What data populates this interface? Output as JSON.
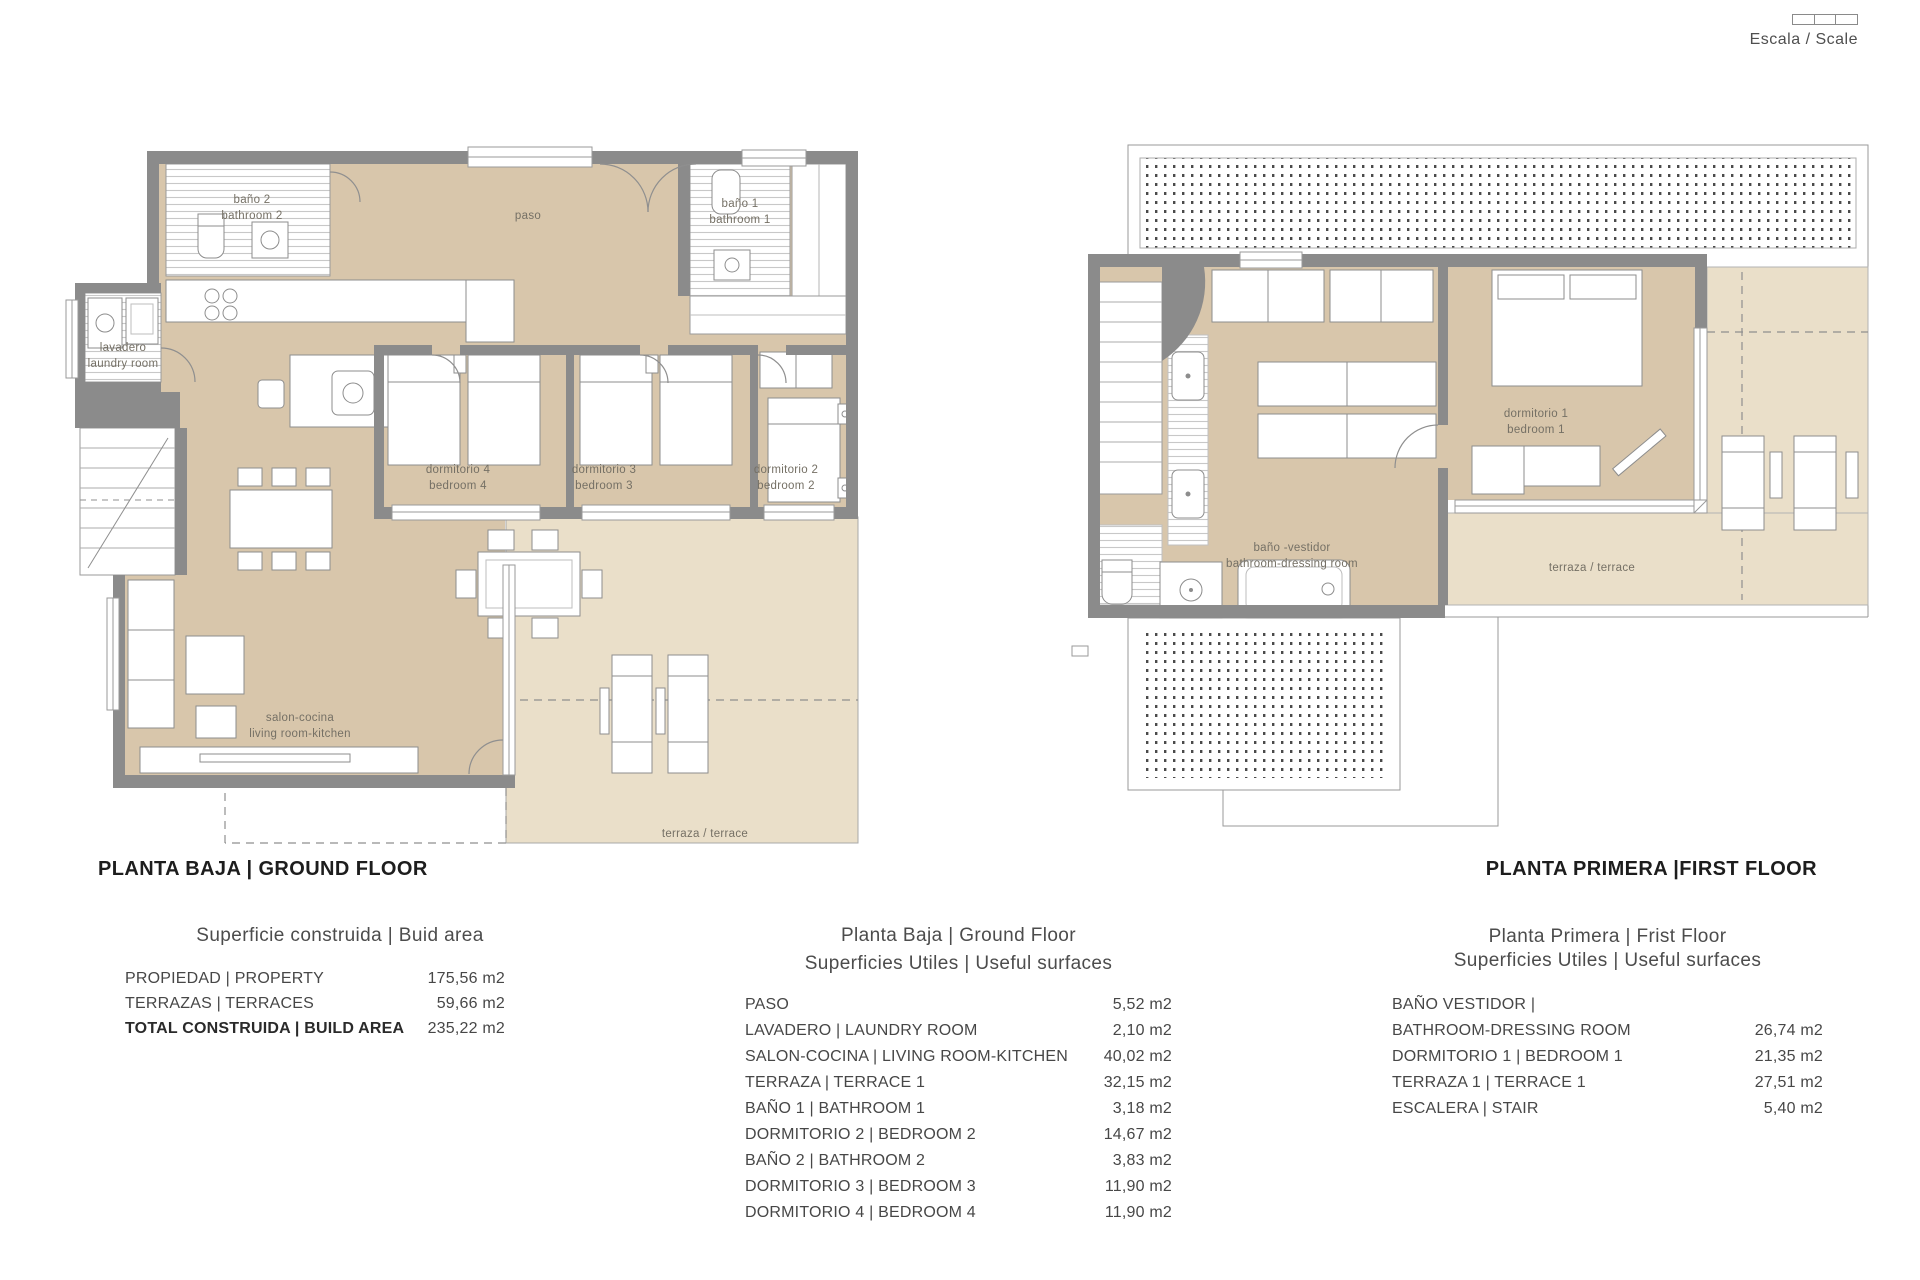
{
  "scale_widget": {
    "label": "Escala / Scale"
  },
  "ground_floor": {
    "title": "PLANTA BAJA | GROUND FLOOR",
    "rooms": {
      "bano2": {
        "l1": "baño 2",
        "l2": "bathroom 2"
      },
      "paso": {
        "l1": "paso"
      },
      "bano1": {
        "l1": "baño 1",
        "l2": "bathroom 1"
      },
      "lavadero": {
        "l1": "lavadero",
        "l2": "laundry room"
      },
      "dorm4": {
        "l1": "dormitorio 4",
        "l2": "bedroom 4"
      },
      "dorm3": {
        "l1": "dormitorio 3",
        "l2": "bedroom 3"
      },
      "dorm2": {
        "l1": "dormitorio 2",
        "l2": "bedroom 2"
      },
      "salon": {
        "l1": "salon-cocina",
        "l2": "living room-kitchen"
      },
      "terraza": {
        "l1": "terraza / terrace"
      }
    }
  },
  "first_floor": {
    "title": "PLANTA PRIMERA |FIRST FLOOR",
    "rooms": {
      "bano_vestidor": {
        "l1": "baño -vestidor",
        "l2": "bathroom-dressing room"
      },
      "dorm1": {
        "l1": "dormitorio 1",
        "l2": "bedroom 1"
      },
      "terraza": {
        "l1": "terraza / terrace"
      }
    }
  },
  "tables": {
    "build_area": {
      "header": "Superficie construida | Buid area",
      "rows": [
        {
          "label": "PROPIEDAD | PROPERTY",
          "value": "175,56 m2"
        },
        {
          "label": "TERRAZAS | TERRACES",
          "value": "59,66 m2"
        },
        {
          "label": "TOTAL CONSTRUIDA | BUILD AREA",
          "value": "235,22 m2"
        }
      ]
    },
    "ground_useful": {
      "header_l1": "Planta Baja | Ground Floor",
      "header_l2": "Superficies Utiles | Useful surfaces",
      "rows": [
        {
          "label": "PASO",
          "value": "5,52 m2"
        },
        {
          "label": "LAVADERO | LAUNDRY ROOM",
          "value": "2,10 m2"
        },
        {
          "label": "SALON-COCINA | LIVING ROOM-KITCHEN",
          "value": "40,02 m2"
        },
        {
          "label": "TERRAZA | TERRACE 1",
          "value": "32,15 m2"
        },
        {
          "label": "BAÑO 1 | BATHROOM 1",
          "value": "3,18 m2"
        },
        {
          "label": "DORMITORIO 2 | BEDROOM 2",
          "value": "14,67 m2"
        },
        {
          "label": "BAÑO 2 | BATHROOM 2",
          "value": "3,83 m2"
        },
        {
          "label": "DORMITORIO 3 | BEDROOM 3",
          "value": "11,90 m2"
        },
        {
          "label": "DORMITORIO 4 | BEDROOM 4",
          "value": "11,90 m2"
        }
      ]
    },
    "first_useful": {
      "header_l1": "Planta Primera | Frist Floor",
      "header_l2": "Superficies Utiles | Useful surfaces",
      "rows": [
        {
          "label": "BAÑO VESTIDOR |",
          "value": ""
        },
        {
          "label": "BATHROOM-DRESSING ROOM",
          "value": "26,74 m2"
        },
        {
          "label": "DORMITORIO 1 | BEDROOM 1",
          "value": "21,35 m2"
        },
        {
          "label": "TERRAZA 1 | TERRACE 1",
          "value": "27,51 m2"
        },
        {
          "label": "ESCALERA | STAIR",
          "value": "5,40 m2"
        }
      ]
    }
  },
  "colors": {
    "wall": "#8b8b8b",
    "interior_floor": "#d8c6ab",
    "terrace_floor": "#eadfc9",
    "line": "#9a9a9a"
  }
}
